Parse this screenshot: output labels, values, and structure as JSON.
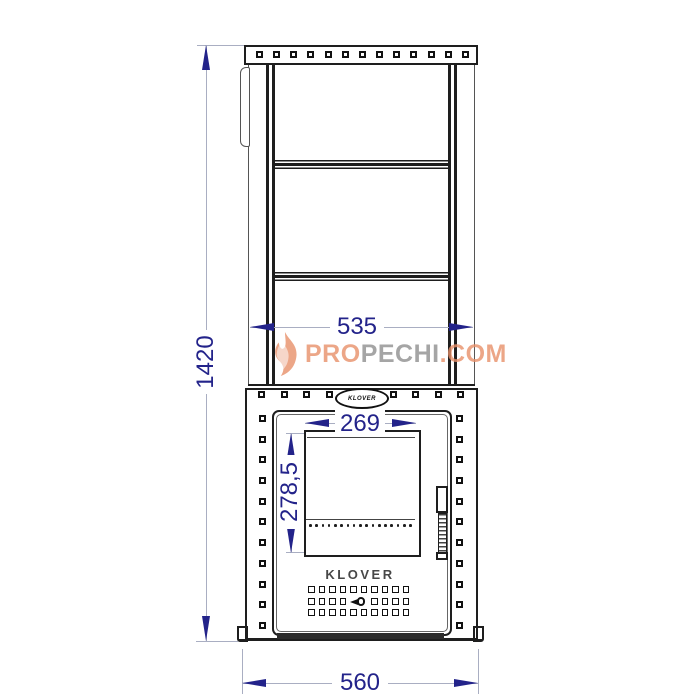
{
  "drawing": {
    "title": "KLOVER stove front view technical drawing",
    "dimensions": {
      "overall_height": "1420",
      "cage_width": "535",
      "base_width": "560",
      "glass_width": "269",
      "glass_height": "278,5"
    },
    "brand": "KLOVER",
    "oval_badge": "KLOVER",
    "counts": {
      "cap_holes": 13,
      "firebox_top_holes_left": 4,
      "firebox_top_holes_right": 4,
      "firebox_side_holes": 11,
      "glass_dots": 17,
      "vent_cols": 10,
      "vent_mid_side": 4
    },
    "colors": {
      "line": "#1e1e1e",
      "dim_text": "#23238a",
      "dim_line": "#a9aec2",
      "watermark_orange": "#e8906a",
      "watermark_gray": "#8f8f8f"
    }
  },
  "watermark": {
    "pro": "PRO",
    "pechi": "PECHI",
    "com": ".COM"
  }
}
